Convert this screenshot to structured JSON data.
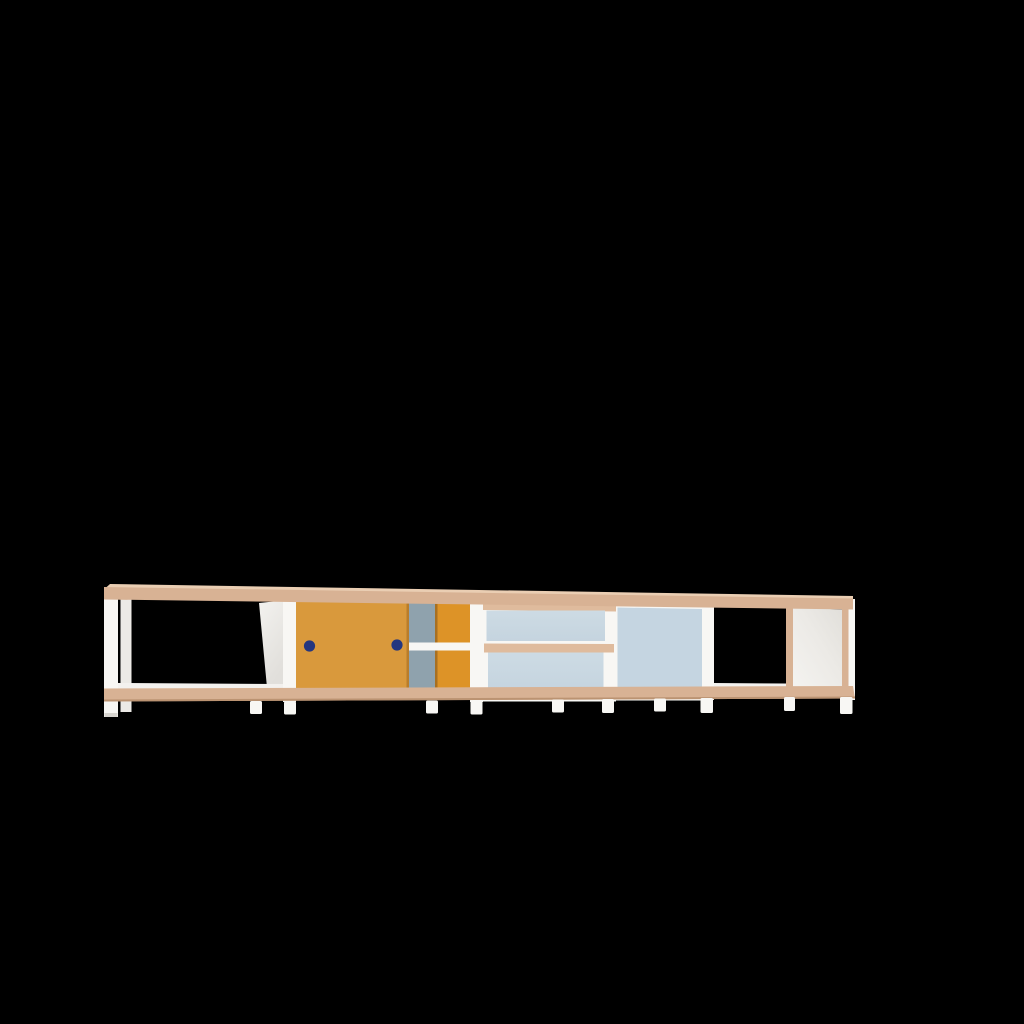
{
  "colors": {
    "background": "#000000",
    "frame_white": "#f8f7f4",
    "frame_white_dim": "#eceae6",
    "wood": "#d8b294",
    "wood_light": "#eaceb3",
    "wood_rail": "#dfbb9d",
    "wood_dark": "#bb9372",
    "door_orange": "#d9993c",
    "door_orange_rear": "#dd9327",
    "door_orange_edge": "#a86f20",
    "handle_navy": "#24367f",
    "back_panel_grey_blue": "#8fa2ad",
    "drawer_blue": "#c9d8e2",
    "sliding_panel_blue": "#c5d5e1",
    "end_panel_light": "#f3f1ee",
    "end_panel_shade": "#e2dfda",
    "foot_tip": "#d8d5d0"
  },
  "object": {
    "label": "Low modular sideboard rendered on a plain black background",
    "view": "front view with slight right-receding perspective"
  },
  "furniture": {
    "sections": [
      {
        "label": "Open cube compartment with white frame and wood-edge shelves"
      },
      {
        "label": "Cabinet bay with orange sliding door and two navy round handles"
      },
      {
        "label": "Interior behind door: grey-blue back panel, white mid shelf, rear orange sliding door"
      },
      {
        "label": "Drawer module with two stacked light-blue drawers and wood rails"
      },
      {
        "label": "Bay with large light-blue sliding panel"
      },
      {
        "label": "Open cube compartment with wood divider and white right end panel"
      }
    ],
    "handle_count": 2,
    "drawer_count": 2,
    "open_compartments": 2,
    "feet": "small white cylindrical feet"
  }
}
